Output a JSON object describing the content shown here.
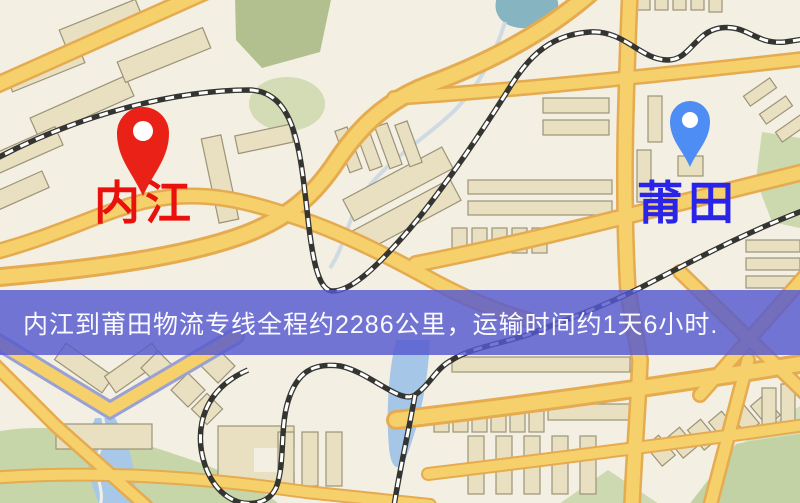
{
  "pins": {
    "origin": {
      "label": "内江",
      "pin_color": "#e92117",
      "label_color": "#ea100c"
    },
    "destination": {
      "label": "莆田",
      "pin_color": "#4e8df4",
      "label_color": "#2a23e8"
    }
  },
  "banner": {
    "text": "内江到莆田物流专线全程约2286公里，运输时间约1天6小时.",
    "bg_color": "#5659d0",
    "text_color": "#fbfbff"
  },
  "map_palette": {
    "background": "#f4efe3",
    "road_fill": "#f6d06b",
    "road_casing": "#e5ab50",
    "building_fill": "#e9e0c1",
    "building_outline": "#9c9378",
    "park_green": "#c9d8a9",
    "olive_green": "#b2bf8e",
    "water_blue": "#a5c6e6",
    "pond_teal": "#86b4c0",
    "railway_dark": "#343431"
  }
}
